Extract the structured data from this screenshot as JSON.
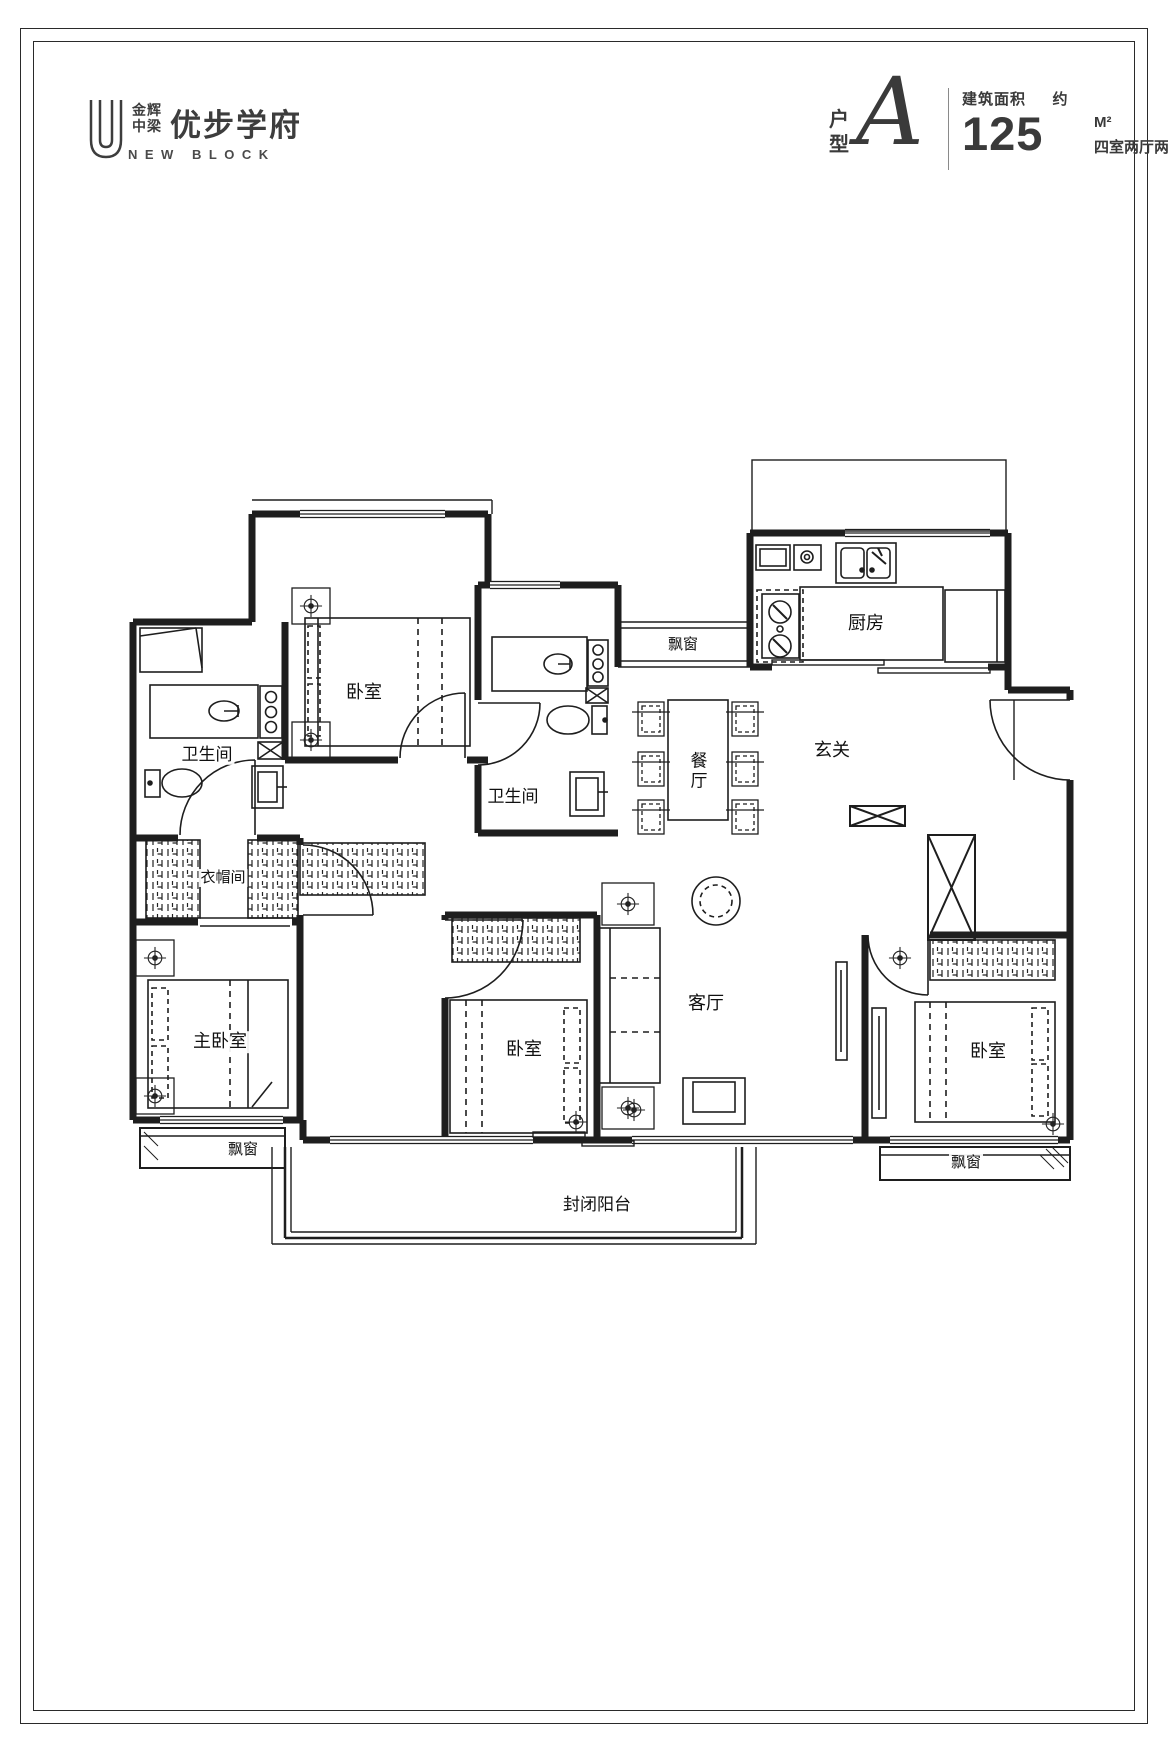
{
  "header": {
    "logo": {
      "brand_line1": "金辉",
      "brand_line2": "中梁",
      "project_name": "优步学府",
      "subtitle": "NEW BLOCK"
    },
    "unit": {
      "type_label": "户型",
      "type_value": "A",
      "area_label": "建筑面积",
      "area_approx": "约",
      "area_value": "125",
      "area_unit": "M²",
      "layout_desc": "四室两厅两卫"
    }
  },
  "floorplan": {
    "rooms": {
      "bathroom1": "卫生间",
      "bedroom_top": "卧室",
      "bathroom2": "卫生间",
      "bay_window_top": "飘窗",
      "kitchen": "厨房",
      "foyer": "玄关",
      "dining": "餐厅",
      "closet": "衣帽间",
      "master_bedroom": "主卧室",
      "bedroom_middle": "卧室",
      "living_room": "客厅",
      "bedroom_right": "卧室",
      "bay_window_left": "飘窗",
      "bay_window_right": "飘窗",
      "balcony": "封闭阳台"
    },
    "line_color": "#1e1e1e"
  }
}
